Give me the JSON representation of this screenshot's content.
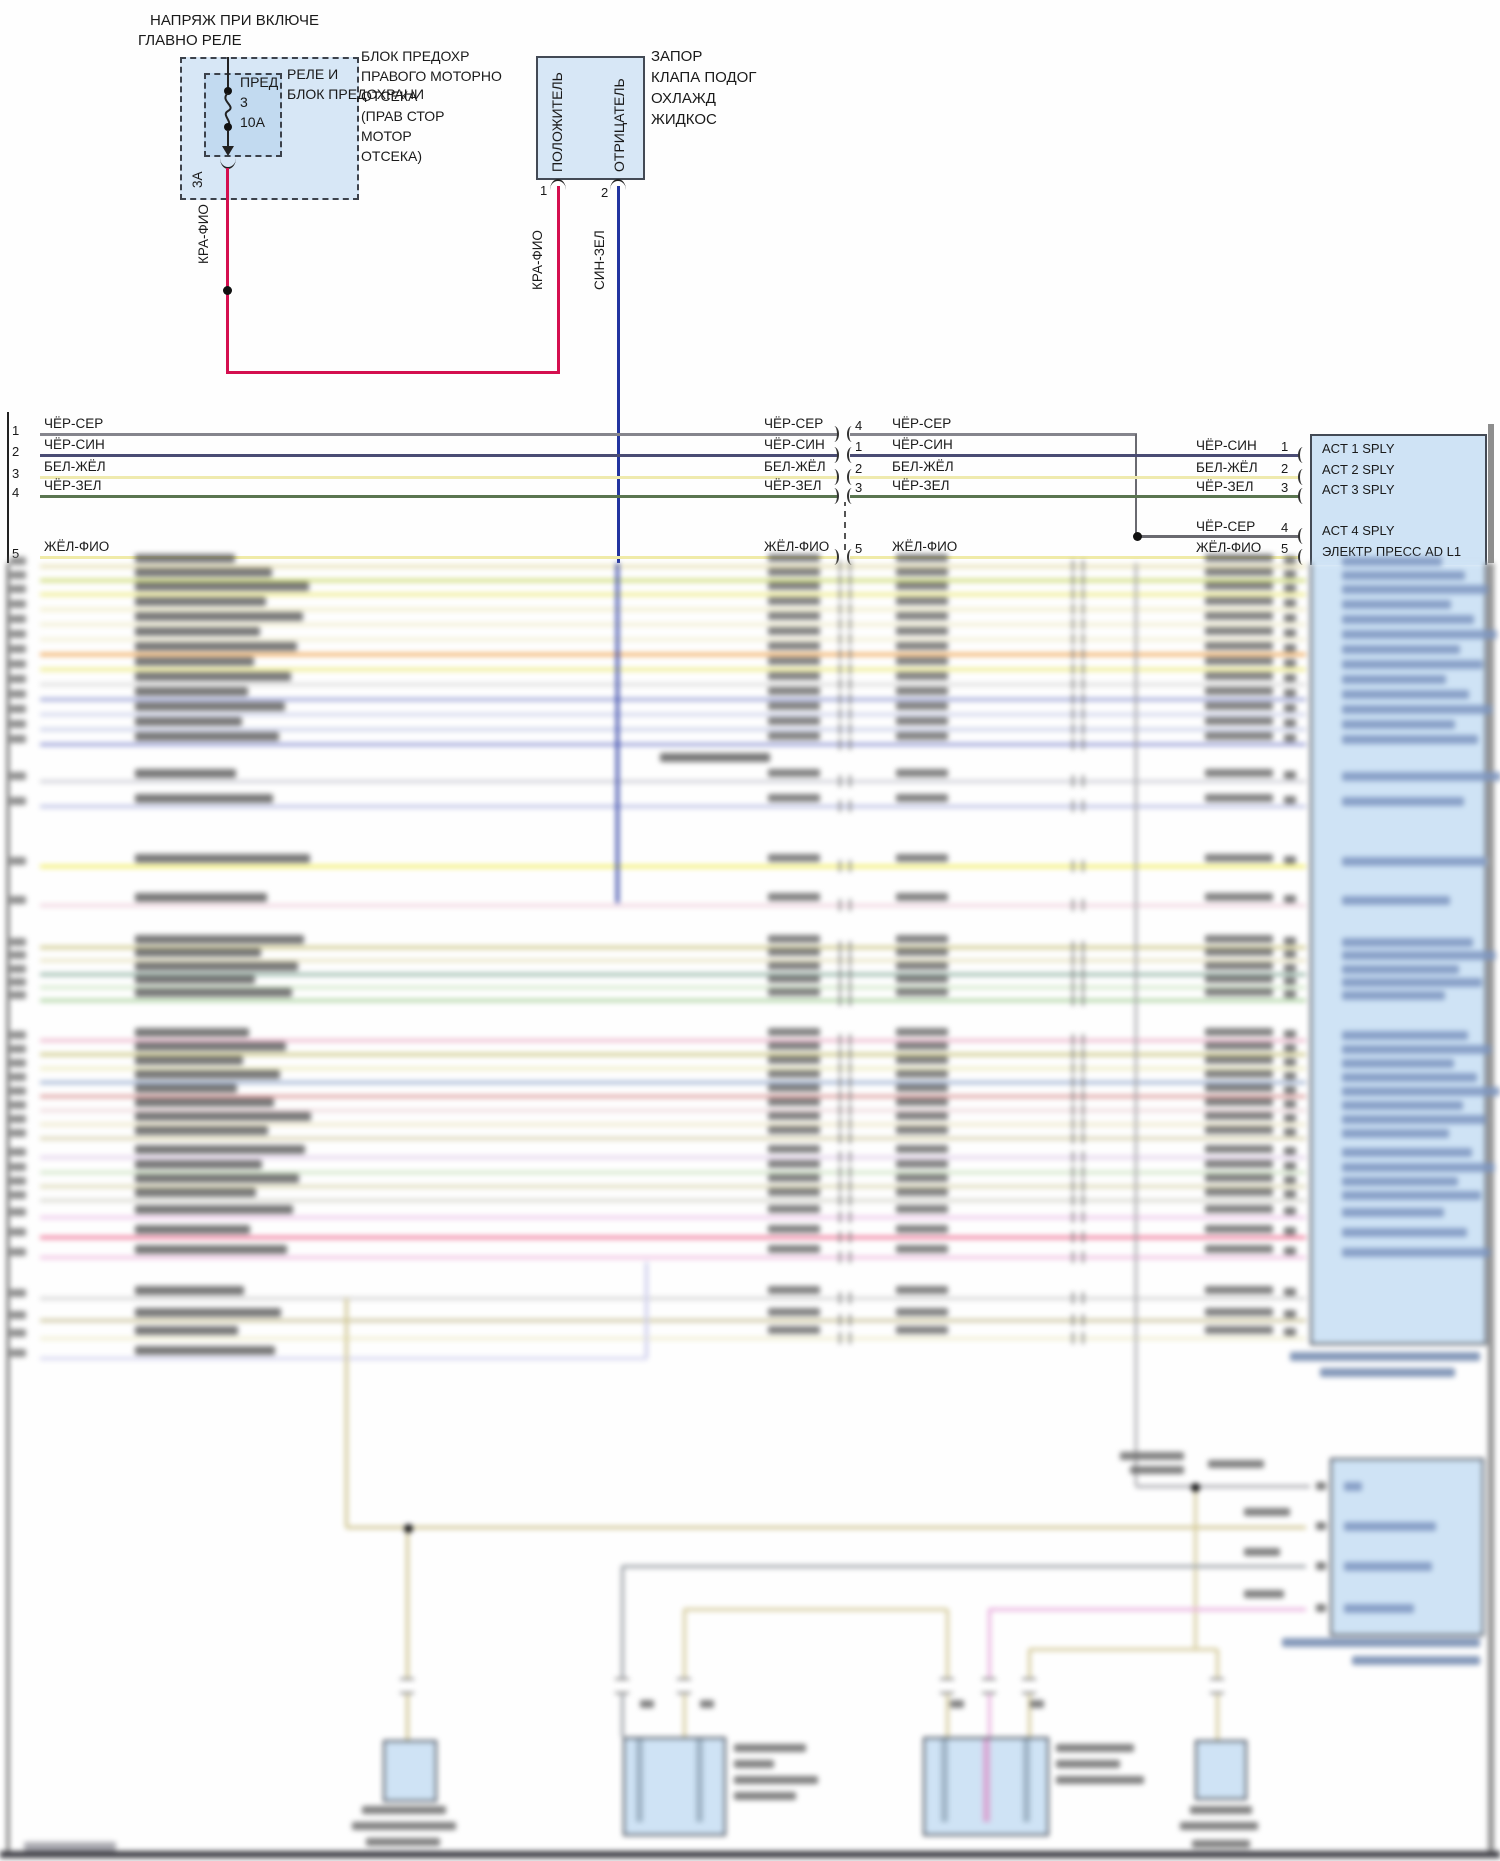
{
  "colors": {
    "box_fill": "#d7e7f6",
    "box_fill_inner": "#c2daf0",
    "device_fill": "#cfe3f5",
    "border": "#434a55",
    "wire_red": "#d40f4f",
    "wire_blue": "#2335a0",
    "frame": "#222222"
  },
  "top_left": {
    "title_line1": "НАПРЯЖ ПРИ ВКЛЮЧЕ",
    "title_line2": "ГЛАВНО РЕЛЕ",
    "fuse_name": "ПРЕД",
    "fuse_num": "3",
    "fuse_amp": "10А",
    "relay_line1": "РЕЛЕ И",
    "relay_line2": "БЛОК ПРЕДОХРАНИ",
    "block_lines": [
      "БЛОК ПРЕДОХР",
      "ПРАВОГО МОТОРНО",
      "ОТСЕКА",
      "(ПРАВ СТОР",
      "МОТОР",
      "ОТСЕКА)"
    ],
    "amp_label": "3А",
    "wire_label": "КРА-ФИО"
  },
  "valve": {
    "label_lines": [
      "ЗАПОР",
      "КЛАПА ПОДОГ",
      "ОХЛАЖД",
      "ЖИДКОС"
    ],
    "pin1_label": "ПОЛОЖИТЕЛЬ",
    "pin2_label": "ОТРИЦАТЕЛЬ",
    "pin1_num": "1",
    "pin2_num": "2",
    "wire1_label": "КРА-ФИО",
    "wire2_label": "СИН-ЗЕЛ"
  },
  "bus": {
    "rows": [
      {
        "left_pin": "1",
        "label": "ЧЁР-СЕР",
        "mid_pin": "4",
        "right_pin": "4",
        "color": "#85858d",
        "y": 434,
        "right_y": 536
      },
      {
        "left_pin": "2",
        "label": "ЧЁР-СИН",
        "mid_pin": "1",
        "right_pin": "1",
        "color": "#4a4c74",
        "y": 455,
        "right_y": 455
      },
      {
        "left_pin": "3",
        "label": "БЕЛ-ЖЁЛ",
        "mid_pin": "2",
        "right_pin": "2",
        "color": "#efeaae",
        "y": 477,
        "right_y": 477
      },
      {
        "left_pin": "4",
        "label": "ЧЁР-ЗЕЛ",
        "mid_pin": "3",
        "right_pin": "3",
        "color": "#5a7550",
        "y": 496,
        "right_y": 496
      },
      {
        "left_pin": "5",
        "label": "ЖЁЛ-ФИО",
        "mid_pin": "5",
        "right_pin": "5",
        "color": "#f0eba8",
        "y": 557,
        "right_y": 557
      }
    ]
  },
  "device": {
    "pins": [
      {
        "num": "1",
        "label": "ACT 1 SPLY",
        "ty": 440
      },
      {
        "num": "2",
        "label": "ACT 2 SPLY",
        "ty": 461
      },
      {
        "num": "3",
        "label": "ACT 3 SPLY",
        "ty": 481
      },
      {
        "num": "4",
        "label": "ACT 4 SPLY",
        "ty": 522
      },
      {
        "num": "5",
        "label": "ЭЛЕКТР ПРЕСС AD L1",
        "ty": 543
      }
    ]
  },
  "blur": {
    "rows": [
      [
        566,
        "#e6dfae"
      ],
      [
        580,
        "#cbd96a"
      ],
      [
        594,
        "#eeeb80"
      ],
      [
        609,
        "#f1edc6"
      ],
      [
        624,
        "#f1edcd"
      ],
      [
        639,
        "#f3efd2"
      ],
      [
        654,
        "#f0a44e"
      ],
      [
        669,
        "#eeeb7e"
      ],
      [
        684,
        "#dcdcdc"
      ],
      [
        699,
        "#9aa2d6"
      ],
      [
        714,
        "#cdd2ec"
      ],
      [
        729,
        "#c7cde8"
      ],
      [
        744,
        "#9097d4"
      ],
      [
        781,
        "#cdced6"
      ],
      [
        806,
        "#babfe4"
      ],
      [
        866,
        "#f2ee58"
      ],
      [
        905,
        "#f0d2de"
      ],
      [
        947,
        "#cdc785"
      ],
      [
        960,
        "#e8e3c0"
      ],
      [
        974,
        "#8fb2a2"
      ],
      [
        987,
        "#d0e8c6"
      ],
      [
        1000,
        "#a8d29c"
      ],
      [
        1040,
        "#edb6cc"
      ],
      [
        1054,
        "#ccc782"
      ],
      [
        1068,
        "#eeecc0"
      ],
      [
        1082,
        "#9cb0d2"
      ],
      [
        1096,
        "#db9898"
      ],
      [
        1110,
        "#eed8dc"
      ],
      [
        1124,
        "#eee8c8"
      ],
      [
        1138,
        "#d8d2ae"
      ],
      [
        1157,
        "#e3d1ec"
      ],
      [
        1172,
        "#cfe4c4"
      ],
      [
        1186,
        "#dcd8b4"
      ],
      [
        1200,
        "#d6d6ce"
      ],
      [
        1217,
        "#eec6ea"
      ],
      [
        1237,
        "#ef6f93"
      ],
      [
        1257,
        "#f0bfe2"
      ],
      [
        1298,
        "#d4d4d4",
        40,
        1306,
        0
      ],
      [
        1320,
        "#cbc49a",
        40,
        1306,
        0
      ],
      [
        1338,
        "#f0eecf",
        40,
        1306,
        0
      ],
      [
        1358,
        "#d5d5f0",
        40,
        647,
        0
      ]
    ],
    "verticals": [
      [
        617,
        563,
        903,
        "#2335a0",
        3
      ],
      [
        1136,
        563,
        1486,
        "#8f8f95",
        2.5
      ],
      [
        646,
        1262,
        1358,
        "#c9c9ec",
        3
      ],
      [
        346,
        1298,
        1527,
        "#cfc48e",
        3
      ],
      [
        407,
        1528,
        1740,
        "#cfc48e",
        3
      ],
      [
        622,
        1566,
        1737,
        "#9aa0a6",
        3
      ],
      [
        684,
        1609,
        1737,
        "#d5cb9b",
        3
      ],
      [
        947,
        1609,
        1737,
        "#d5cb9b",
        3
      ],
      [
        989,
        1609,
        1737,
        "#e9aede",
        3
      ],
      [
        1029,
        1649,
        1737,
        "#d5cb9b",
        3
      ],
      [
        1217,
        1649,
        1740,
        "#d5cb9b",
        3
      ],
      [
        1195,
        1487,
        1650,
        "#d5cb9b",
        3
      ]
    ],
    "horizontals": [
      [
        1136,
        1310,
        1486,
        "#a8a8ae",
        3
      ],
      [
        346,
        1306,
        1527,
        "#cfc48e",
        3
      ],
      [
        622,
        1306,
        1566,
        "#9aa0a6",
        3
      ],
      [
        684,
        947,
        1609,
        "#d5cb9b",
        3
      ],
      [
        989,
        1306,
        1609,
        "#e9aede",
        3
      ],
      [
        1029,
        1217,
        1649,
        "#d5cb9b",
        3
      ]
    ],
    "dots": [
      [
        1195,
        1487
      ],
      [
        408,
        1528
      ],
      [
        408,
        1789
      ],
      [
        1218,
        1789
      ]
    ],
    "breaks": [
      [
        407,
        1686
      ],
      [
        622,
        1686
      ],
      [
        684,
        1686
      ],
      [
        947,
        1686
      ],
      [
        989,
        1686
      ],
      [
        1029,
        1686
      ],
      [
        1217,
        1686
      ]
    ],
    "boxes": [
      {
        "x": 383,
        "y": 1740,
        "w": 50,
        "h": 58
      },
      {
        "x": 623,
        "y": 1737,
        "w": 99,
        "h": 95,
        "strips": [
          [
            636,
            "#9fb4c6"
          ],
          [
            696,
            "#9fb4c6"
          ]
        ]
      },
      {
        "x": 923,
        "y": 1737,
        "w": 122,
        "h": 95,
        "strips": [
          [
            941,
            "#9fb4c6"
          ],
          [
            983,
            "#d9a8d4"
          ],
          [
            1023,
            "#9fb4c6"
          ]
        ]
      },
      {
        "x": 1195,
        "y": 1740,
        "w": 48,
        "h": 56
      },
      {
        "x": 1330,
        "y": 1458,
        "w": 150,
        "h": 174,
        "strips": []
      }
    ],
    "device_caption": [
      [
        1290,
        1352,
        190
      ],
      [
        1320,
        1368,
        135
      ]
    ],
    "blobs": [
      [
        660,
        753,
        110,
        9,
        "#606060"
      ],
      [
        1344,
        1482,
        18,
        9,
        "#7d95c0"
      ],
      [
        1344,
        1522,
        92,
        9,
        "#7d95c0"
      ],
      [
        1344,
        1562,
        88,
        9,
        "#7d95c0"
      ],
      [
        1344,
        1604,
        70,
        9,
        "#7d95c0"
      ],
      [
        1316,
        1482,
        10,
        8,
        "#666666"
      ],
      [
        1316,
        1522,
        10,
        8,
        "#666666"
      ],
      [
        1316,
        1562,
        10,
        8,
        "#666666"
      ],
      [
        1316,
        1604,
        10,
        8,
        "#666666"
      ],
      [
        1244,
        1508,
        46,
        8,
        "#6b6b6b"
      ],
      [
        1244,
        1548,
        36,
        8,
        "#6b6b6b"
      ],
      [
        1244,
        1590,
        40,
        8,
        "#6b6b6b"
      ],
      [
        1120,
        1452,
        64,
        8,
        "#6b6b6b"
      ],
      [
        1130,
        1466,
        54,
        8,
        "#6b6b6b"
      ],
      [
        1208,
        1460,
        56,
        8,
        "#6b6b6b"
      ],
      [
        1282,
        1638,
        198,
        9,
        "#6f86ad"
      ],
      [
        1352,
        1656,
        128,
        9,
        "#6f86ad"
      ],
      [
        362,
        1806,
        84,
        8,
        "#6b6b6b"
      ],
      [
        352,
        1822,
        104,
        8,
        "#6b6b6b"
      ],
      [
        366,
        1838,
        74,
        8,
        "#6b6b6b"
      ],
      [
        734,
        1744,
        72,
        8,
        "#6b6b6b"
      ],
      [
        734,
        1760,
        40,
        8,
        "#6b6b6b"
      ],
      [
        734,
        1776,
        84,
        8,
        "#6b6b6b"
      ],
      [
        734,
        1792,
        62,
        8,
        "#6b6b6b"
      ],
      [
        1056,
        1744,
        78,
        8,
        "#6b6b6b"
      ],
      [
        1056,
        1760,
        64,
        8,
        "#6b6b6b"
      ],
      [
        1056,
        1776,
        88,
        8,
        "#6b6b6b"
      ],
      [
        1190,
        1806,
        62,
        8,
        "#6b6b6b"
      ],
      [
        1180,
        1822,
        78,
        8,
        "#6b6b6b"
      ],
      [
        1192,
        1840,
        58,
        8,
        "#6b6b6b"
      ],
      [
        640,
        1700,
        14,
        8,
        "#6b6b6b"
      ],
      [
        700,
        1700,
        14,
        8,
        "#6b6b6b"
      ],
      [
        950,
        1700,
        14,
        8,
        "#6b6b6b"
      ],
      [
        1030,
        1700,
        14,
        8,
        "#6b6b6b"
      ],
      [
        24,
        1842,
        92,
        9,
        "#9a9aa2"
      ]
    ]
  }
}
